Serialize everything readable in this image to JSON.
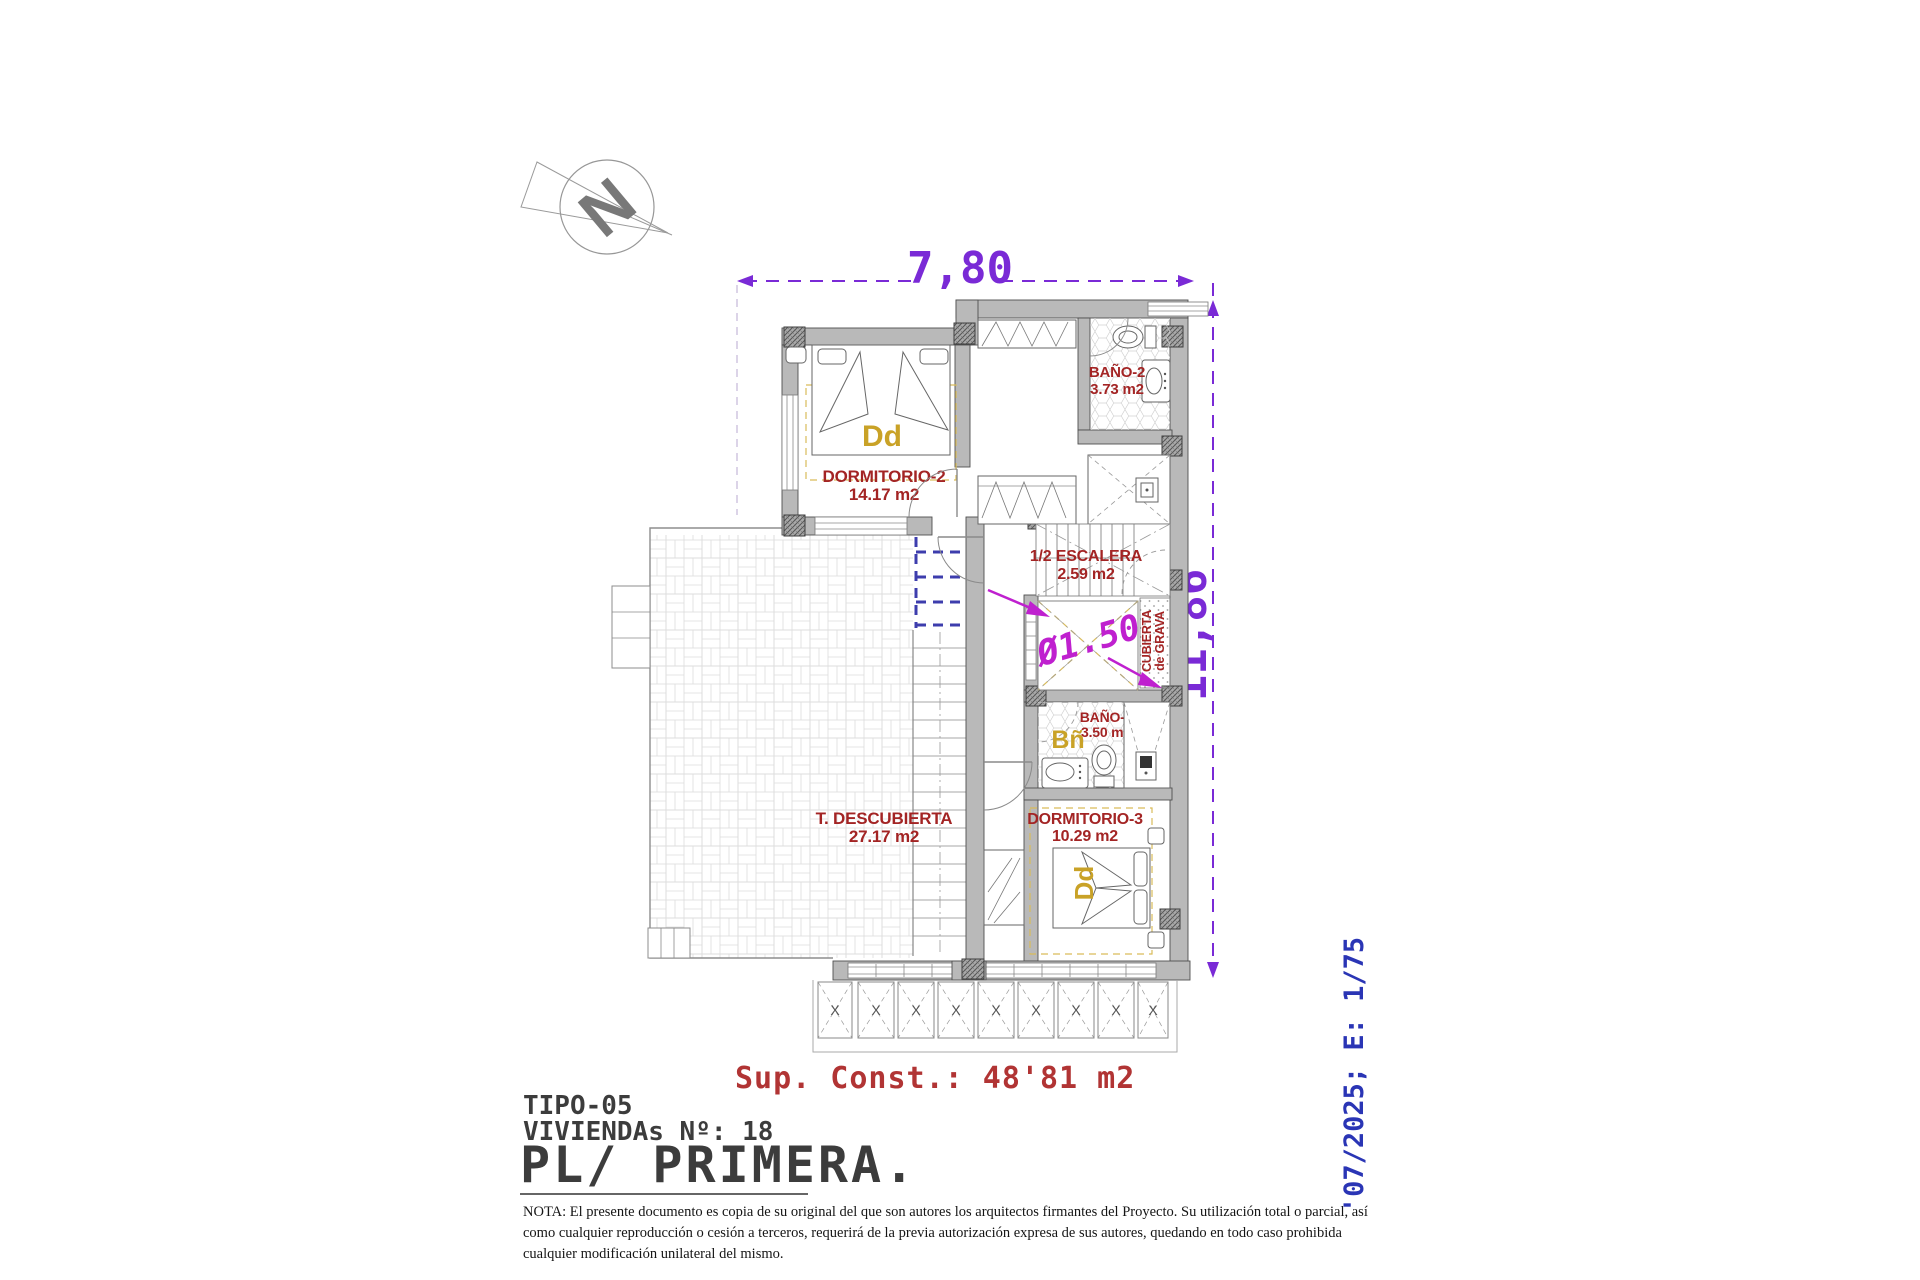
{
  "colors": {
    "dimension_purple": "#7a2ad6",
    "annotation_magenta": "#bf20cf",
    "room_label_red": "#a32424",
    "area_note_red": "#b13434",
    "furniture_tag_yellow": "#c9a227",
    "date_scale_blue": "#2a35b5",
    "wall_gray": "#b9b9b9",
    "projection_blue": "#3d3dad"
  },
  "north": {
    "label": "N"
  },
  "dimensions": {
    "width": "7,80",
    "height": "11,86",
    "diameter": "Ø1.50"
  },
  "rooms": {
    "dormitorio2": {
      "name": "DORMITORIO-2",
      "area": "14.17 m2"
    },
    "bano2": {
      "name": "BAÑO-2",
      "area": "3.73 m2"
    },
    "escalera": {
      "name": "1/2 ESCALERA",
      "area": "2.59 m2"
    },
    "bano3": {
      "name": "BAÑO-3",
      "area": "3.50 m2"
    },
    "dormitorio3": {
      "name": "DORMITORIO-3",
      "area": "10.29 m2"
    },
    "terraza": {
      "name": "T. DESCUBIERTA",
      "area": "27.17 m2"
    }
  },
  "annotations": {
    "bed_tag": "Dd",
    "bath_tag": "Bñ",
    "cubierta_line1": "CUBIERTA",
    "cubierta_line2": "de GRAVA",
    "pergola_mark": "X"
  },
  "footer": {
    "sup_const": "Sup. Const.: 48'81 m2",
    "tipo": "TIPO-05",
    "viviendas": "VIVIENDAs Nº: 18",
    "planta": "PL/ PRIMERA.",
    "nota_line1": "NOTA: El presente documento es copia de su original del que son autores los arquitectos firmantes del Proyecto. Su utilización total o parcial, así",
    "nota_line2": "como cualquier reproducción o cesión a terceros, requerirá  de la previa autorización expresa de sus autores, quedando en todo caso prohibida",
    "nota_line3": "cualquier modificación unilateral del mismo.",
    "date_scale": "'07/2025; E: 1/75"
  }
}
